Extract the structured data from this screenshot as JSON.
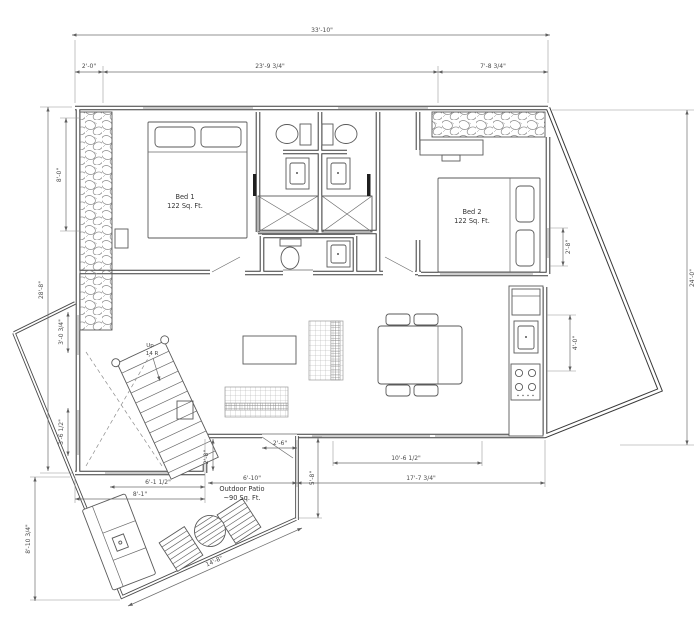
{
  "drawing": {
    "rooms": {
      "bed1": {
        "name": "Bed 1",
        "area": "122 Sq. Ft."
      },
      "bed2": {
        "name": "Bed 2",
        "area": "122 Sq. Ft."
      },
      "kitchen_dining": {
        "name": "Kitchen / Dining",
        "area": "168 Sq. Ft."
      },
      "outdoor_patio": {
        "name": "Outdoor Patio",
        "area": "~90 Sq. Ft."
      }
    },
    "stairs": {
      "direction": "Up",
      "risers": "14 R"
    },
    "dims": {
      "overall_width": "33'-10\"",
      "seg_left": "2'-0\"",
      "seg_mid": "23'-9 3/4\"",
      "seg_right": "7'-8 3/4\"",
      "stone_height": "8'-0\"",
      "overall_left": "28'-8\"",
      "overall_right": "24'-0\"",
      "bed2_wall": "2'-8\"",
      "kitchen_wall": "4'-0\"",
      "win_upper": "3'-0 3/4\"",
      "win_lower": "3'-6 1/2\"",
      "stair_width": "6'-1 1/2\"",
      "stair_room_width": "8'-1\"",
      "notch": "2'-8\"",
      "patio_door": "2'-6\"",
      "patio_top": "6'-10\"",
      "patio_side": "5'-8\"",
      "kitchen_window": "10'-6 1/2\"",
      "living_width": "17'-7 3/4\"",
      "patio_left": "8'-10 3/4\"",
      "patio_edge": "14'-8\""
    }
  }
}
